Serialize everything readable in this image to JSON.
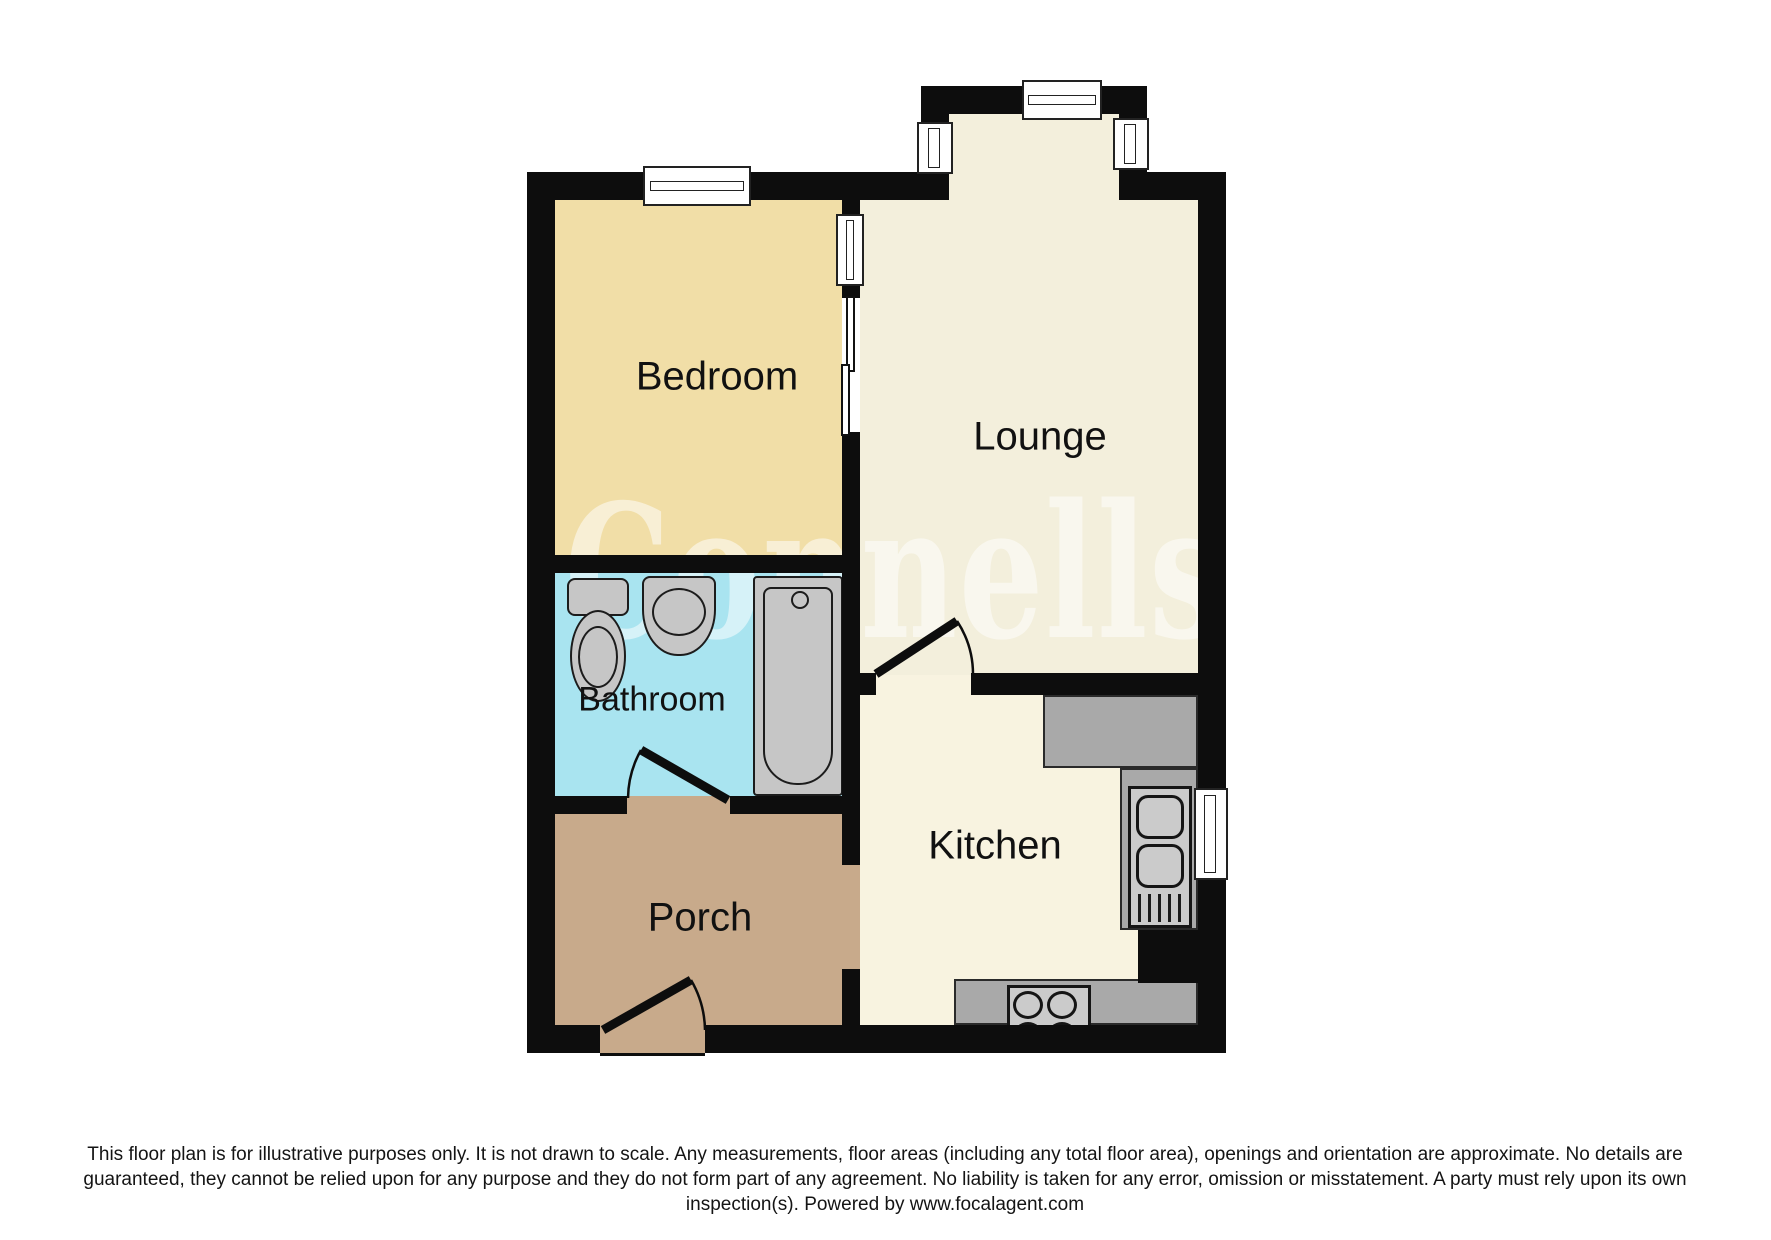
{
  "watermark": {
    "text": "Connells"
  },
  "rooms": {
    "bedroom": {
      "label": "Bedroom",
      "fill": "#f1dea7"
    },
    "lounge": {
      "label": "Lounge",
      "fill": "#f3efdc"
    },
    "bathroom": {
      "label": "Bathroom",
      "fill": "#a9e4f0"
    },
    "kitchen": {
      "label": "Kitchen",
      "fill": "#f8f3e0"
    },
    "porch": {
      "label": "Porch",
      "fill": "#c8aa8b"
    }
  },
  "fixtures": [
    "toilet",
    "wash-basin",
    "bathtub",
    "kitchen-sink",
    "hob",
    "worktops"
  ],
  "features": [
    "windows",
    "sliding-door-bedroom-lounge",
    "door-lounge-kitchen",
    "door-bathroom",
    "front-door-porch"
  ],
  "colors": {
    "wall": "#0d0d0d",
    "counter": "#a9a9a9",
    "fixture": "#c6c6c6",
    "window": "#ffffff",
    "watermark": "rgba(255,255,255,0.52)"
  },
  "footer": {
    "text": "This floor plan is for illustrative purposes only. It is not drawn to scale. Any measurements, floor areas (including any total floor area), openings and orientation are approximate. No details are guaranteed, they cannot be relied upon for any purpose and they do not form part of any agreement. No liability is taken for any error, omission or misstatement. A party must rely upon its own inspection(s). Powered by www.focalagent.com"
  }
}
